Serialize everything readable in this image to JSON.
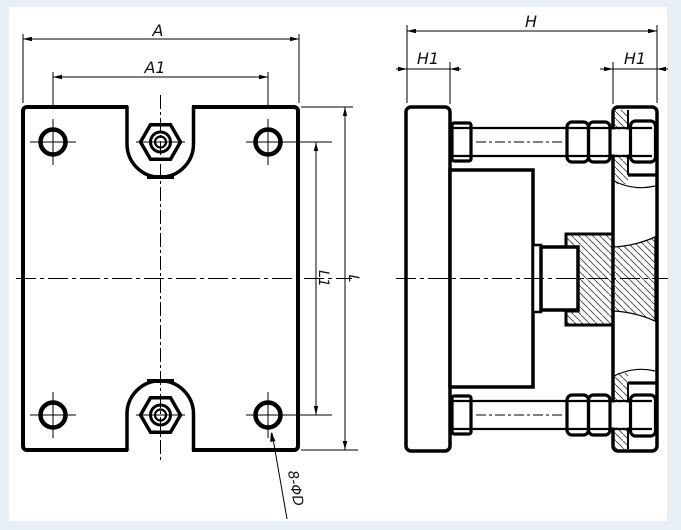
{
  "front_view": {
    "dim_a": "A",
    "dim_a1": "A1",
    "dim_l": "L",
    "dim_l1": "L1",
    "holes_note": "8-ΦD"
  },
  "side_view": {
    "dim_h": "H",
    "dim_h1_left": "H1",
    "dim_h1_right": "H1"
  },
  "colors": {
    "page_bg": "#e9eff7",
    "canvas_bg": "#ffffff",
    "canvas_border": "#dfe7f0",
    "line": "#000000",
    "hatch": "#555555"
  }
}
